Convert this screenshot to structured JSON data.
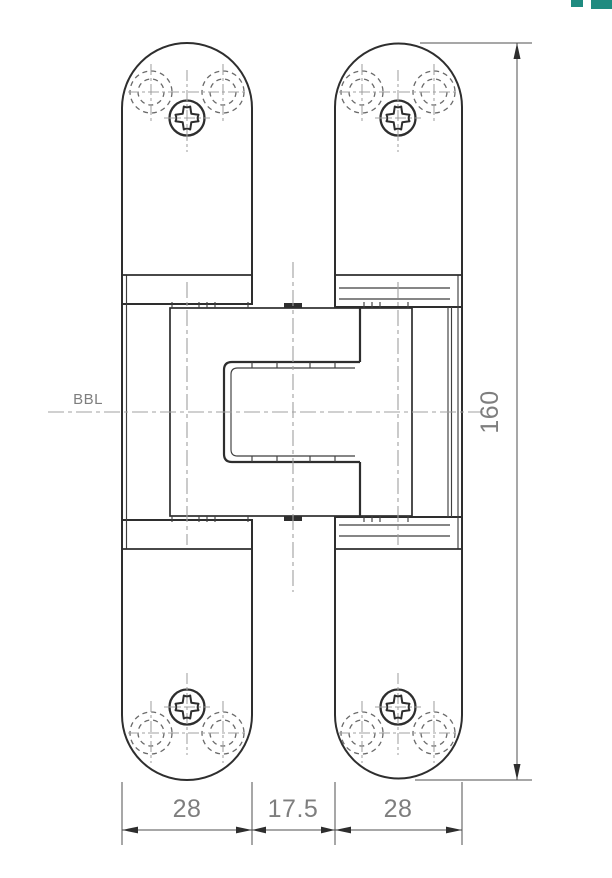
{
  "page": {
    "background": "#ffffff"
  },
  "colors": {
    "page": "#ffffff",
    "outline": "#2e2e2e",
    "thin": "#3f3f3f",
    "centerline": "#a0a0a0",
    "hole": "#6b6b6b",
    "dim": "#4f4f4f",
    "dimtext": "#7e7e7e",
    "accent": "#1f8b80"
  },
  "drawing": {
    "type": "technical-drawing",
    "subject": "concealed door hinge, front view, closed position",
    "centerline_label": "BBL",
    "dimensions": {
      "leaf_width_left": "28",
      "axis_gap": "17.5",
      "leaf_width_right": "28",
      "overall_height": "160"
    }
  },
  "logo": {
    "description": "teal brand logo fragment, cropped at top edge"
  }
}
